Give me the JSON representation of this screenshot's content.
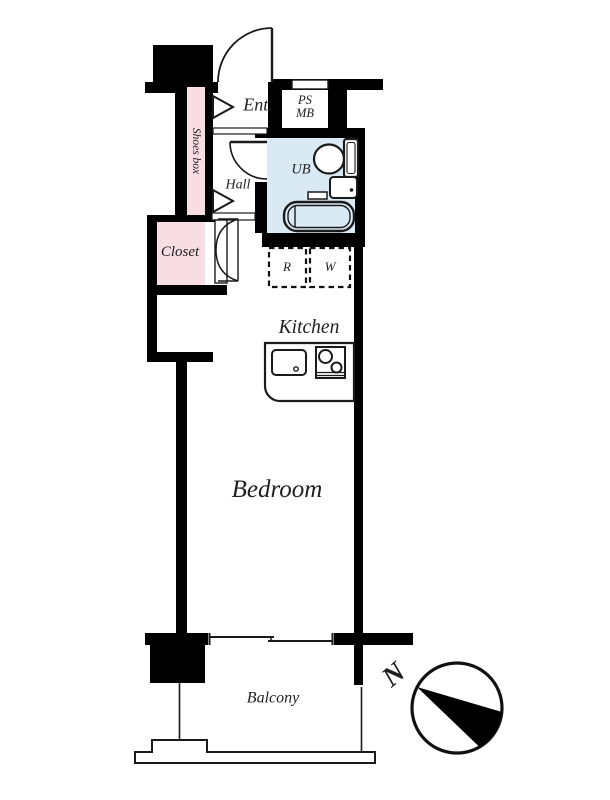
{
  "floorplan": {
    "rooms": {
      "entrance": "Ent.",
      "ps_line1": "PS",
      "ps_line2": "MB",
      "shoes_box": "Shoes box",
      "hall": "Hall",
      "unit_bath": "UB",
      "closet": "Closet",
      "refrigerator_space": "R",
      "washer_space": "W",
      "kitchen": "Kitchen",
      "bedroom": "Bedroom",
      "balcony": "Balcony"
    },
    "compass": {
      "north_label": "N"
    },
    "fixtures": [
      "entrance-door",
      "bath-door",
      "closet-double-door",
      "toilet",
      "washbasin",
      "bathtub",
      "kitchen-sink",
      "stove",
      "sliding-window",
      "compass-rose"
    ],
    "colors": {
      "wall": "#000000",
      "closet_fill": "#f8dee3",
      "shoes_box_fill": "#f8dee3",
      "bath_fill": "#d9eaf4",
      "line": "#1a1a1a",
      "text": "#1f1f1f"
    }
  }
}
